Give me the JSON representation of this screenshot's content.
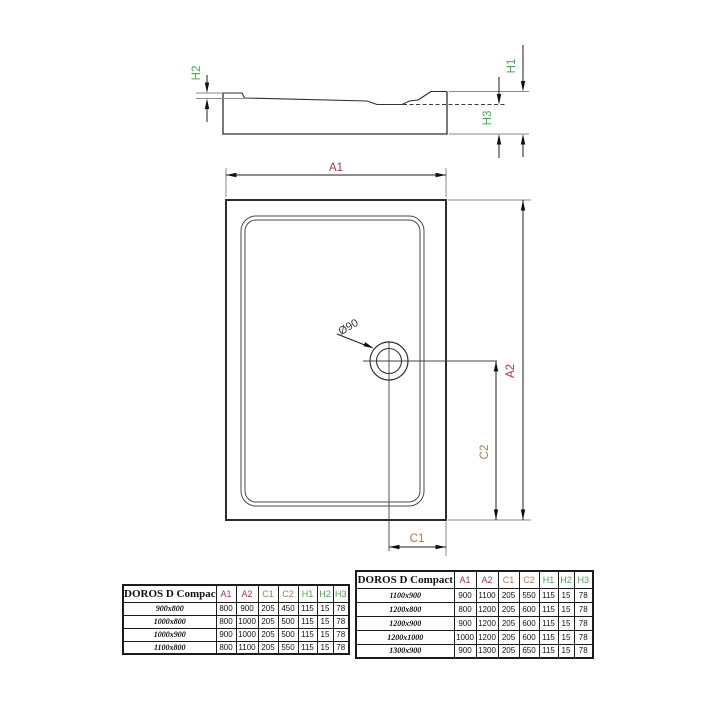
{
  "diagram": {
    "section_labels": {
      "h1": "H1",
      "h2": "H2",
      "h3": "H3"
    },
    "plan_labels": {
      "a1": "A1",
      "a2": "A2",
      "c1": "C1",
      "c2": "C2"
    },
    "drain_label": "Ø90"
  },
  "colors": {
    "dim_a": "#a5383e",
    "dim_c": "#ad7a4d",
    "dim_h": "#46a94b"
  },
  "tables": [
    {
      "title": "DOROS D Compact",
      "columns": [
        "A1",
        "A2",
        "C1",
        "C2",
        "H1",
        "H2",
        "H3"
      ],
      "column_colors": [
        "#a5383e",
        "#a5383e",
        "#ad7a4d",
        "#ad7a4d",
        "#46a94b",
        "#46a94b",
        "#46a94b"
      ],
      "rows": [
        {
          "model": "900x800",
          "values": [
            "800",
            "900",
            "205",
            "450",
            "115",
            "15",
            "78"
          ]
        },
        {
          "model": "1000x800",
          "values": [
            "800",
            "1000",
            "205",
            "500",
            "115",
            "15",
            "78"
          ]
        },
        {
          "model": "1000x900",
          "values": [
            "900",
            "1000",
            "205",
            "500",
            "115",
            "15",
            "78"
          ]
        },
        {
          "model": "1100x800",
          "values": [
            "800",
            "1100",
            "205",
            "550",
            "115",
            "15",
            "78"
          ]
        }
      ]
    },
    {
      "title": "DOROS D Compact",
      "columns": [
        "A1",
        "A2",
        "C1",
        "C2",
        "H1",
        "H2",
        "H3"
      ],
      "column_colors": [
        "#a5383e",
        "#a5383e",
        "#ad7a4d",
        "#ad7a4d",
        "#46a94b",
        "#46a94b",
        "#46a94b"
      ],
      "rows": [
        {
          "model": "1100x900",
          "values": [
            "900",
            "1100",
            "205",
            "550",
            "115",
            "15",
            "78"
          ]
        },
        {
          "model": "1200x800",
          "values": [
            "800",
            "1200",
            "205",
            "600",
            "115",
            "15",
            "78"
          ]
        },
        {
          "model": "1200x900",
          "values": [
            "900",
            "1200",
            "205",
            "600",
            "115",
            "15",
            "78"
          ]
        },
        {
          "model": "1200x1000",
          "values": [
            "1000",
            "1200",
            "205",
            "600",
            "115",
            "15",
            "78"
          ]
        },
        {
          "model": "1300x900",
          "values": [
            "900",
            "1300",
            "205",
            "650",
            "115",
            "15",
            "78"
          ]
        }
      ]
    }
  ]
}
